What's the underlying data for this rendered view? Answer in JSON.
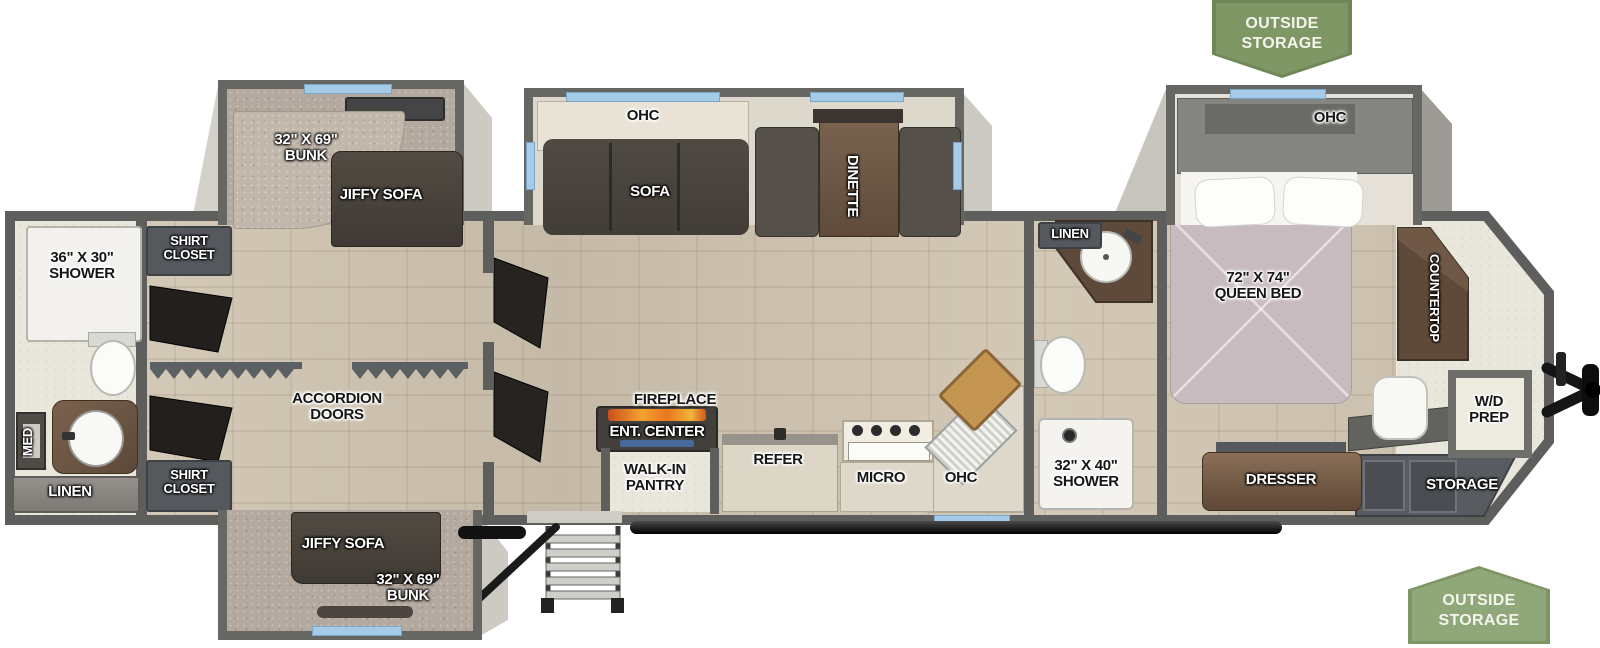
{
  "banners": {
    "top": "OUTSIDE\nSTORAGE",
    "bottom": "OUTSIDE\nSTORAGE"
  },
  "rear_bath": {
    "shower": "36\" X 30\"\nSHOWER",
    "med": "MED",
    "linen": "LINEN"
  },
  "wardrobe": {
    "closet_top": "SHIRT\nCLOSET",
    "closet_bottom": "SHIRT\nCLOSET",
    "accordion": "ACCORDION\nDOORS"
  },
  "bunk_top": {
    "bunk": "32\" X 69\"\nBUNK",
    "sofa": "JIFFY SOFA"
  },
  "bunk_bottom": {
    "bunk": "32\" X 69\"\nBUNK",
    "sofa": "JIFFY SOFA"
  },
  "living": {
    "ohc": "OHC",
    "sofa": "SOFA",
    "dinette": "DINETTE"
  },
  "kitchen": {
    "fireplace": "FIREPLACE",
    "ent_center": "ENT. CENTER",
    "pantry": "WALK-IN\nPANTRY",
    "refer": "REFER",
    "micro": "MICRO",
    "ohc": "OHC"
  },
  "mid_bath": {
    "linen": "LINEN",
    "shower": "32\" X 40\"\nSHOWER"
  },
  "bedroom": {
    "ohc": "OHC",
    "bed": "72\" X 74\"\nQUEEN BED",
    "countertop": "COUNTERTOP",
    "dresser": "DRESSER",
    "wd_prep": "W/D\nPREP",
    "storage": "STORAGE"
  },
  "colors": {
    "wall": "#5e5e5c",
    "window": "#a6cbe8",
    "banner_green": "#7e9565",
    "carpet": "#b3a99e",
    "wood_floor": "#ccc1af",
    "bedspread": "#c8bbc0"
  }
}
